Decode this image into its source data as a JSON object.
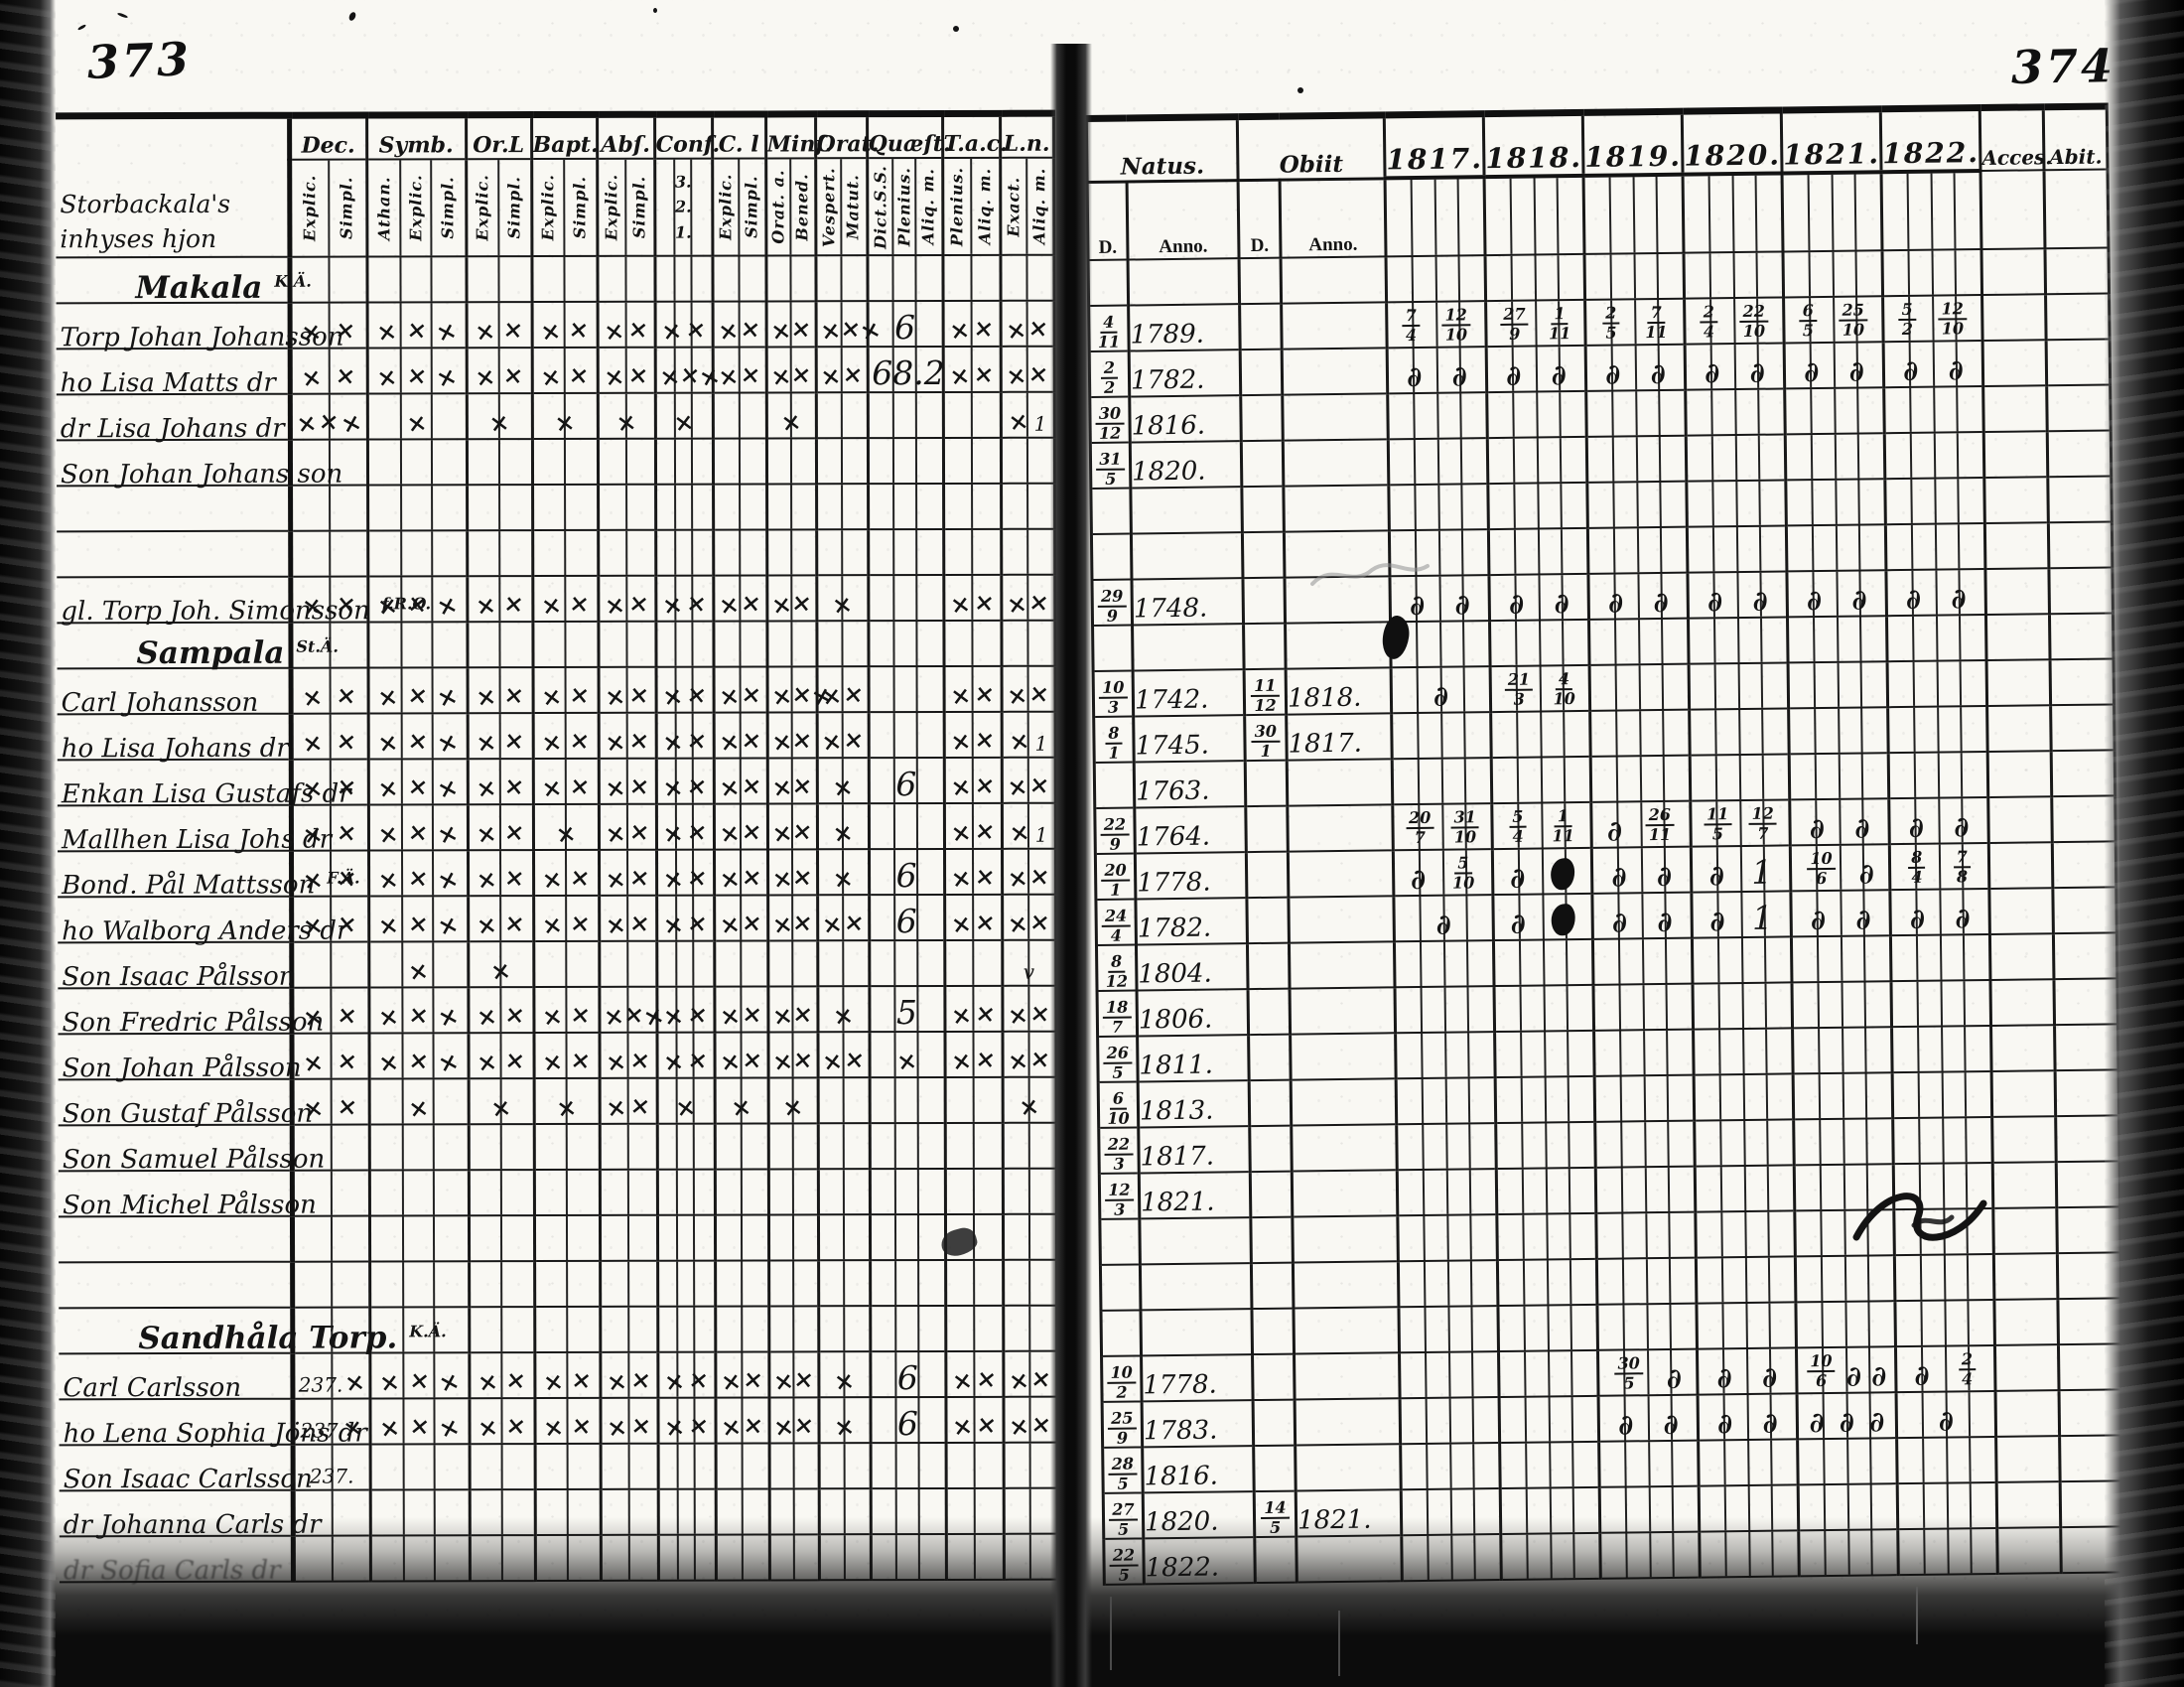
{
  "colors": {
    "ink": "#141414",
    "paper": "#f9f8f3"
  },
  "left_page": {
    "page_number": "373",
    "margin_note": [
      "Storbackala's",
      "inhyses hjon"
    ],
    "columns": [
      {
        "label": "Dec.",
        "subs": [
          "Explic.",
          "Simpl."
        ]
      },
      {
        "label": "Symb.",
        "subs": [
          "Athan.",
          "Explic.",
          "Simpl."
        ]
      },
      {
        "label": "Or.L",
        "subs": [
          "Explic.",
          "Simpl."
        ]
      },
      {
        "label": "Bapt.",
        "subs": [
          "Explic.",
          "Simpl."
        ]
      },
      {
        "label": "Abſ.",
        "subs": [
          "Explic.",
          "Simpl."
        ]
      },
      {
        "label": "Conf.",
        "subs": [
          "3.",
          "2.",
          "1."
        ],
        "stack": true
      },
      {
        "label": "C. l",
        "subs": [
          "Explic.",
          "Simpl."
        ]
      },
      {
        "label": "Minſ.",
        "subs": [
          "Orat. a.",
          "Bened."
        ]
      },
      {
        "label": "Orat.",
        "subs": [
          "Vespert.",
          "Matut."
        ]
      },
      {
        "label": "Quæſt.",
        "subs": [
          "Dict.S.S.",
          "Plenius.",
          "Aliq. m."
        ]
      },
      {
        "label": "T.a.c.",
        "subs": [
          "Plenius.",
          "Aliq. m."
        ]
      },
      {
        "label": "L.n.",
        "subs": [
          "Exact.",
          "Aliq. m."
        ]
      }
    ]
  },
  "right_page": {
    "page_number": "374",
    "natus_label": "Natus.",
    "obiit_label": "Obiit",
    "d_label": "D.",
    "anno_label": "Anno.",
    "years": [
      "1817.",
      "1818.",
      "1819.",
      "1820.",
      "1821.",
      "1822."
    ],
    "acces_label": "Acces.",
    "abit_label": "Abit."
  },
  "rows": [
    {
      "type": "heading",
      "name": "Makala",
      "sup": "K.Ä."
    },
    {
      "name": "Torp Johan Johansson",
      "marks": [
        "xx",
        "xxx",
        "xx",
        "xx",
        "xx",
        "xx",
        "xx",
        "xx",
        "xxx",
        "6",
        "xx",
        "xx"
      ],
      "natus": {
        "d": "4/11",
        "anno": "1789."
      },
      "years": [
        "7/4 12/10",
        "27/9 1/11",
        "2/5 7/11",
        "2/4 22/10",
        "6/5 25/10",
        "5/2 12/10"
      ]
    },
    {
      "name": "ho Lisa Matts dr",
      "marks": [
        "xx",
        "xxx",
        "xx",
        "xx",
        "xx",
        "xxx",
        "xx",
        "xx",
        "xx",
        "68.2",
        "xx",
        "xx"
      ],
      "natus": {
        "d": "2/2",
        "anno": "1782."
      },
      "years": [
        "d d",
        "d d",
        "d d",
        "d d",
        "d d",
        "d d"
      ]
    },
    {
      "name": "dr Lisa Johans dr",
      "marks": [
        "xxx",
        "x",
        "x",
        "x",
        "x",
        "x",
        "",
        "x",
        "",
        "",
        "",
        "x1"
      ],
      "natus": {
        "d": "30/12",
        "anno": "1816."
      }
    },
    {
      "name": "Son Johan Johans son",
      "natus": {
        "d": "31/5",
        "anno": "1820."
      }
    },
    {
      "type": "blank"
    },
    {
      "type": "blank"
    },
    {
      "name": "gl. Torp Joh. Simonsson",
      "sup": "f.R.O.",
      "marks": [
        "xx",
        "xxx",
        "xx",
        "xx",
        "xx",
        "xx",
        "xx",
        "xx",
        "x",
        "",
        "xx",
        "xx"
      ],
      "natus": {
        "d": "29/9",
        "anno": "1748."
      },
      "years": [
        "d d",
        "d d",
        "d d",
        "d d",
        "d d",
        "d d"
      ]
    },
    {
      "type": "heading",
      "name": "Sampala",
      "sup": "St.Ä."
    },
    {
      "name": "Carl Johansson",
      "marks": [
        "xx",
        "xxx",
        "xx",
        "xx",
        "xx",
        "xx",
        "xx",
        "xxx",
        "xx",
        "",
        "xx",
        "xx"
      ],
      "natus": {
        "d": "10/3",
        "anno": "1742."
      },
      "obiit": {
        "d": "11/12",
        "anno": "1818."
      },
      "years": [
        "d",
        "21/3 4/10",
        "",
        "",
        "",
        ""
      ]
    },
    {
      "name": "ho Lisa Johans dr",
      "marks": [
        "xx",
        "xxx",
        "xx",
        "xx",
        "xx",
        "xx",
        "xx",
        "xx",
        "xx",
        "",
        "xx",
        "x1"
      ],
      "natus": {
        "d": "8/1",
        "anno": "1745."
      },
      "obiit": {
        "d": "30/1",
        "anno": "1817."
      }
    },
    {
      "name": "Enkan Lisa Gustafs dr",
      "marks": [
        "xx",
        "xxx",
        "xx",
        "xx",
        "xx",
        "xx",
        "xx",
        "xx",
        "x",
        "6",
        "xx",
        "xx"
      ],
      "natus": {
        "d": "",
        "anno": "1763."
      }
    },
    {
      "name": "Mallhen Lisa Johs dr",
      "marks": [
        "xx",
        "xxx",
        "xx",
        "x",
        "xx",
        "xx",
        "xx",
        "xx",
        "x",
        "",
        "xx",
        "x1"
      ],
      "natus": {
        "d": "22/9",
        "anno": "1764."
      },
      "years": [
        "20/7 31/10",
        "5/4 1/11",
        "d 26/11",
        "11/5 12/7",
        "d d",
        "d d"
      ]
    },
    {
      "name": "Bond. Pål Mattsson",
      "sup": "F.Ä.",
      "marks": [
        "xx",
        "xxx",
        "xx",
        "xx",
        "xx",
        "xx",
        "xx",
        "xx",
        "x",
        "6",
        "xx",
        "xx"
      ],
      "natus": {
        "d": "20/1",
        "anno": "1778."
      },
      "years": [
        "d 5/10",
        "d ●",
        "d d",
        "d 1",
        "10/6 d",
        "8/4 7/8"
      ]
    },
    {
      "name": "ho Walborg Anders dr",
      "marks": [
        "xx",
        "xxx",
        "xx",
        "xx",
        "xx",
        "xx",
        "xx",
        "xx",
        "xx",
        "6",
        "xx",
        "xx"
      ],
      "natus": {
        "d": "24/4",
        "anno": "1782."
      },
      "years": [
        "d",
        "d ●",
        "d d",
        "d 1",
        "d d",
        "d d"
      ]
    },
    {
      "name": "Son Isaac Pålsson",
      "marks": [
        "",
        "x",
        "x",
        "",
        "",
        "",
        "",
        "",
        "",
        "",
        "",
        "v"
      ],
      "natus": {
        "d": "8/12",
        "anno": "1804."
      }
    },
    {
      "name": "Son Fredric Pålsson",
      "marks": [
        "xx",
        "xxx",
        "xx",
        "xx",
        "xxx",
        "xx",
        "xx",
        "xx",
        "x",
        "5",
        "xx",
        "xx"
      ],
      "natus": {
        "d": "18/7",
        "anno": "1806."
      }
    },
    {
      "name": "Son Johan Pålsson",
      "marks": [
        "xx",
        "xxx",
        "xx",
        "xx",
        "xx",
        "xx",
        "xx",
        "xx",
        "xx",
        "x",
        "xx",
        "xx"
      ],
      "natus": {
        "d": "26/5",
        "anno": "1811."
      }
    },
    {
      "name": "Son Gustaf Pålsson",
      "marks": [
        "xx",
        "x",
        "x",
        "x",
        "xx",
        "x",
        "x",
        "x",
        "",
        "",
        "",
        "x"
      ],
      "natus": {
        "d": "6/10",
        "anno": "1813."
      }
    },
    {
      "name": "Son Samuel Pålsson",
      "natus": {
        "d": "22/3",
        "anno": "1817."
      }
    },
    {
      "name": "Son Michel Pålsson",
      "natus": {
        "d": "12/3",
        "anno": "1821."
      }
    },
    {
      "type": "blank"
    },
    {
      "type": "blank"
    },
    {
      "type": "heading",
      "name": "Sandhåla Torp.",
      "sup": "K.Ä."
    },
    {
      "name": "Carl Carlsson",
      "marks": [
        "237. x",
        "xxx",
        "xx",
        "xx",
        "xx",
        "xx",
        "xx",
        "xx",
        "x",
        "6",
        "xx",
        "xx"
      ],
      "natus": {
        "d": "10/2",
        "anno": "1778."
      },
      "years": [
        "",
        "",
        "30/5 d",
        "d d",
        "10/6 d d",
        "d 2/4"
      ]
    },
    {
      "name": "ho Lena Sophia Jöns dr",
      "marks": [
        "237 x",
        "xxx",
        "xx",
        "xx",
        "xx",
        "xx",
        "xx",
        "xx",
        "x",
        "6",
        "xx",
        "xx"
      ],
      "natus": {
        "d": "25/9",
        "anno": "1783."
      },
      "years": [
        "",
        "",
        "d d",
        "d d",
        "d d d",
        "d"
      ]
    },
    {
      "name": "Son Isaac Carlsson",
      "marks": [
        "237.",
        "",
        "",
        "",
        "",
        "",
        "",
        "",
        "",
        "",
        "",
        ""
      ],
      "natus": {
        "d": "28/5",
        "anno": "1816."
      }
    },
    {
      "name": "dr Johanna Carls dr",
      "natus": {
        "d": "27/5",
        "anno": "1820."
      },
      "obiit": {
        "d": "14/5",
        "anno": "1821."
      }
    },
    {
      "name": "dr Sofia Carls dr",
      "faded": true,
      "natus": {
        "d": "22/5",
        "anno": "1822."
      }
    }
  ]
}
